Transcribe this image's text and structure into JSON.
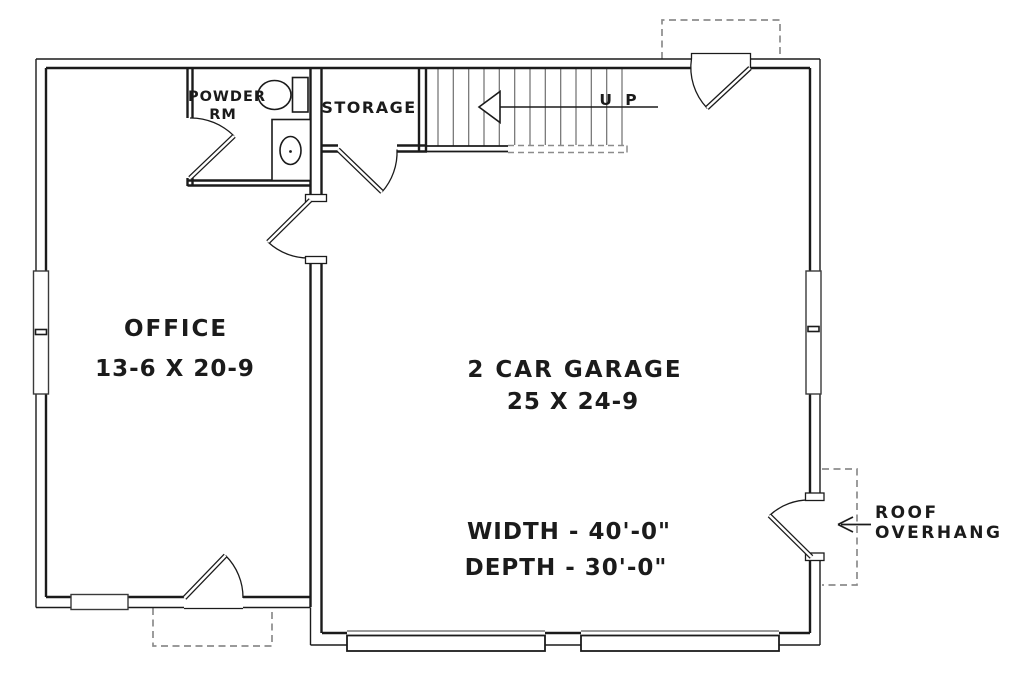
{
  "plan": {
    "rooms": {
      "office": {
        "name": "OFFICE",
        "dims": "13-6 X 20-9"
      },
      "garage": {
        "name": "2 CAR GARAGE",
        "dims": "25 X 24-9"
      },
      "powder": {
        "line1": "POWDER",
        "line2": "RM"
      },
      "storage": {
        "name": "STORAGE"
      }
    },
    "stairs": {
      "direction_label": "U P"
    },
    "overall": {
      "width_label": "WIDTH - 40'-0\"",
      "depth_label": "DEPTH - 30'-0\""
    },
    "annotations": {
      "roof_overhang_line1": "ROOF",
      "roof_overhang_line2": "OVERHANG"
    },
    "colors": {
      "line": "#1b1b1b",
      "dashed_overhang": "#8c8c8c",
      "stair_tread": "#6e6e6e",
      "background": "#ffffff"
    }
  }
}
